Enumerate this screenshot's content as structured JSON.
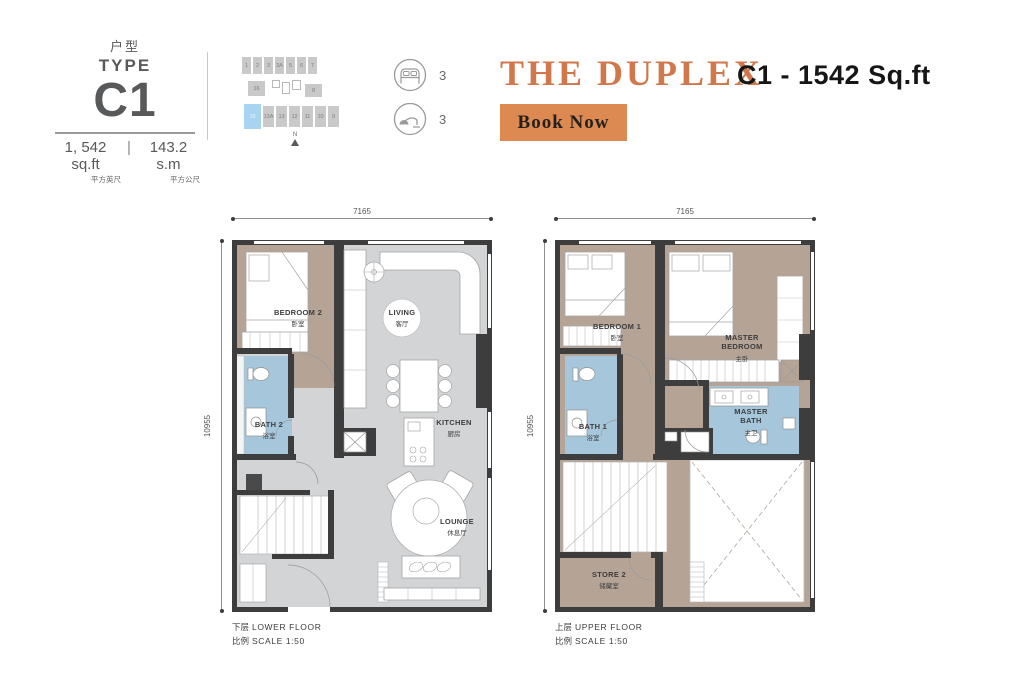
{
  "header": {
    "type_block": {
      "label_cn": "户型",
      "label_en": "TYPE",
      "code": "C1",
      "area_sqft": "1, 542 sq.ft",
      "area_sqft_cn": "平方英尺",
      "area_sep": "|",
      "area_sqm": "143.2 s.m",
      "area_sqm_cn": "平方公尺"
    },
    "keyplan": {
      "top_row": [
        "1",
        "2",
        "3",
        "3A",
        "5",
        "6",
        "7"
      ],
      "mid_left": "16",
      "mid_right": "8",
      "bottom_row": [
        "15",
        "13A",
        "13",
        "12",
        "11",
        "10",
        "9"
      ],
      "highlighted_unit": "15",
      "north_label": "N"
    },
    "stats": [
      {
        "name": "bedrooms",
        "icon": "bed-icon",
        "value": "3"
      },
      {
        "name": "bathrooms",
        "icon": "shower-icon",
        "value": "3"
      }
    ],
    "title": "THE DUPLEX",
    "subtitle": "C1 - 1542 Sq.ft",
    "book_button": {
      "label": "Book Now"
    }
  },
  "plans": [
    {
      "id": "lower",
      "dim_top": "7165",
      "dim_left": "10955",
      "rooms": [
        {
          "name_en": "BEDROOM 2",
          "name_cn": "卧室"
        },
        {
          "name_en": "LIVING",
          "name_cn": "客厅"
        },
        {
          "name_en": "BATH 2",
          "name_cn": "浴室"
        },
        {
          "name_en": "KITCHEN",
          "name_cn": "厨房"
        },
        {
          "name_en": "LOUNGE",
          "name_cn": "休息厅"
        }
      ],
      "caption_cn": "下层",
      "caption_en": "LOWER FLOOR",
      "scale_label_cn": "比例",
      "scale_label_en": "SCALE 1:50"
    },
    {
      "id": "upper",
      "dim_top": "7165",
      "dim_left": "10955",
      "rooms": [
        {
          "name_en": "BEDROOM 1",
          "name_cn": "卧室"
        },
        {
          "name_en": "MASTER BEDROOM",
          "name_cn": "主卧"
        },
        {
          "name_en": "BATH 1",
          "name_cn": "浴室"
        },
        {
          "name_en": "MASTER BATH",
          "name_cn": "主卫"
        },
        {
          "name_en": "STORE 2",
          "name_cn": "储藏室"
        }
      ],
      "caption_cn": "上层",
      "caption_en": "UPPER FLOOR",
      "scale_label_cn": "比例",
      "scale_label_en": "SCALE 1:50"
    }
  ],
  "colors": {
    "accent": "#d0784c",
    "button_bg": "#dd8a52",
    "wall": "#3d3d3d",
    "bedroom_fill": "#b5a496",
    "bath_fill": "#a6c7db",
    "living_fill": "#d2d4d6",
    "keyplan_highlight": "#a9d4f1"
  }
}
